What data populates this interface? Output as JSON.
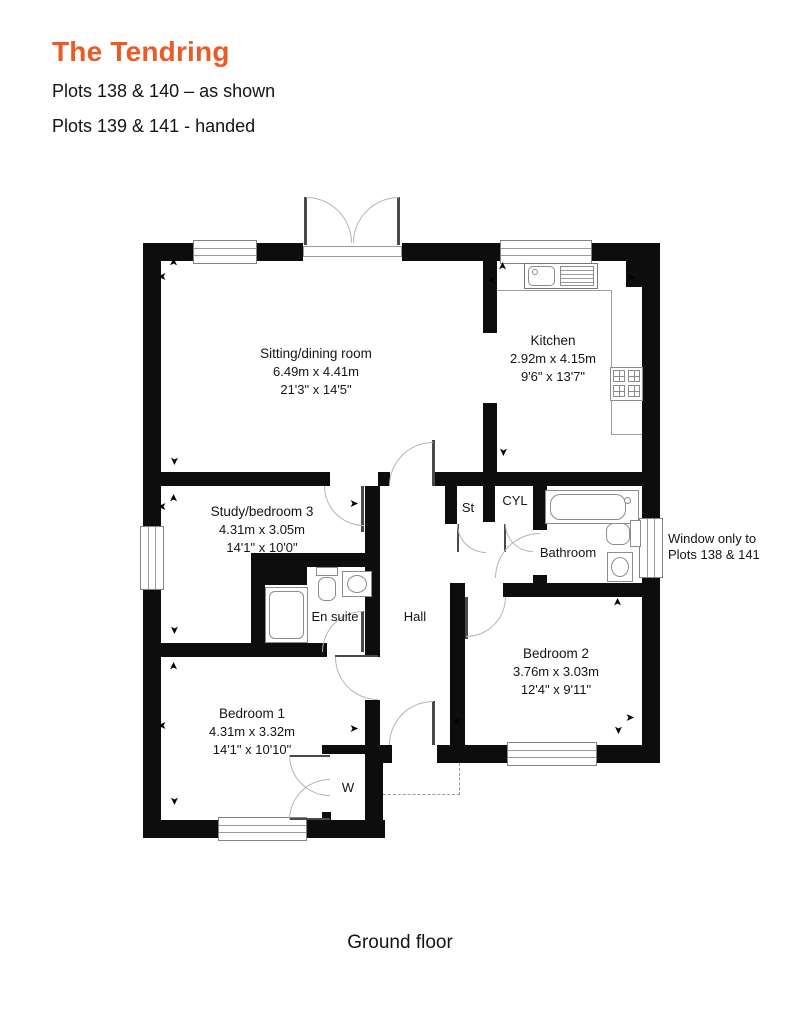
{
  "header": {
    "title": "The Tendring",
    "plots_as_shown": "Plots 138 & 140 – as shown",
    "plots_handed": "Plots 139 & 141 - handed"
  },
  "colors": {
    "accent_orange": "#EB5B28",
    "wall_black": "#0D0D0D"
  },
  "rooms": {
    "sitting": {
      "name": "Sitting/dining room",
      "metric": "6.49m x 4.41m",
      "imperial": "21'3\" x 14'5\""
    },
    "kitchen": {
      "name": "Kitchen",
      "metric": "2.92m x 4.15m",
      "imperial": "9'6\" x 13'7\""
    },
    "study": {
      "name": "Study/bedroom 3",
      "metric": "4.31m x 3.05m",
      "imperial": "14'1\" x 10'0\""
    },
    "bedroom1": {
      "name": "Bedroom 1",
      "metric": "4.31m x 3.32m",
      "imperial": "14'1\" x 10'10\""
    },
    "bedroom2": {
      "name": "Bedroom 2",
      "metric": "3.76m x 3.03m",
      "imperial": "12'4\" x 9'11\""
    },
    "bathroom": {
      "name": "Bathroom"
    },
    "ensuite": {
      "name": "En suite"
    },
    "hall": {
      "name": "Hall"
    },
    "store": {
      "name": "St"
    },
    "cylinder": {
      "name": "CYL"
    },
    "wardrobe": {
      "name": "W"
    }
  },
  "annotation": {
    "window_note_line1": "Window only to",
    "window_note_line2": "Plots 138 & 141"
  },
  "footer": {
    "label": "Ground floor"
  }
}
